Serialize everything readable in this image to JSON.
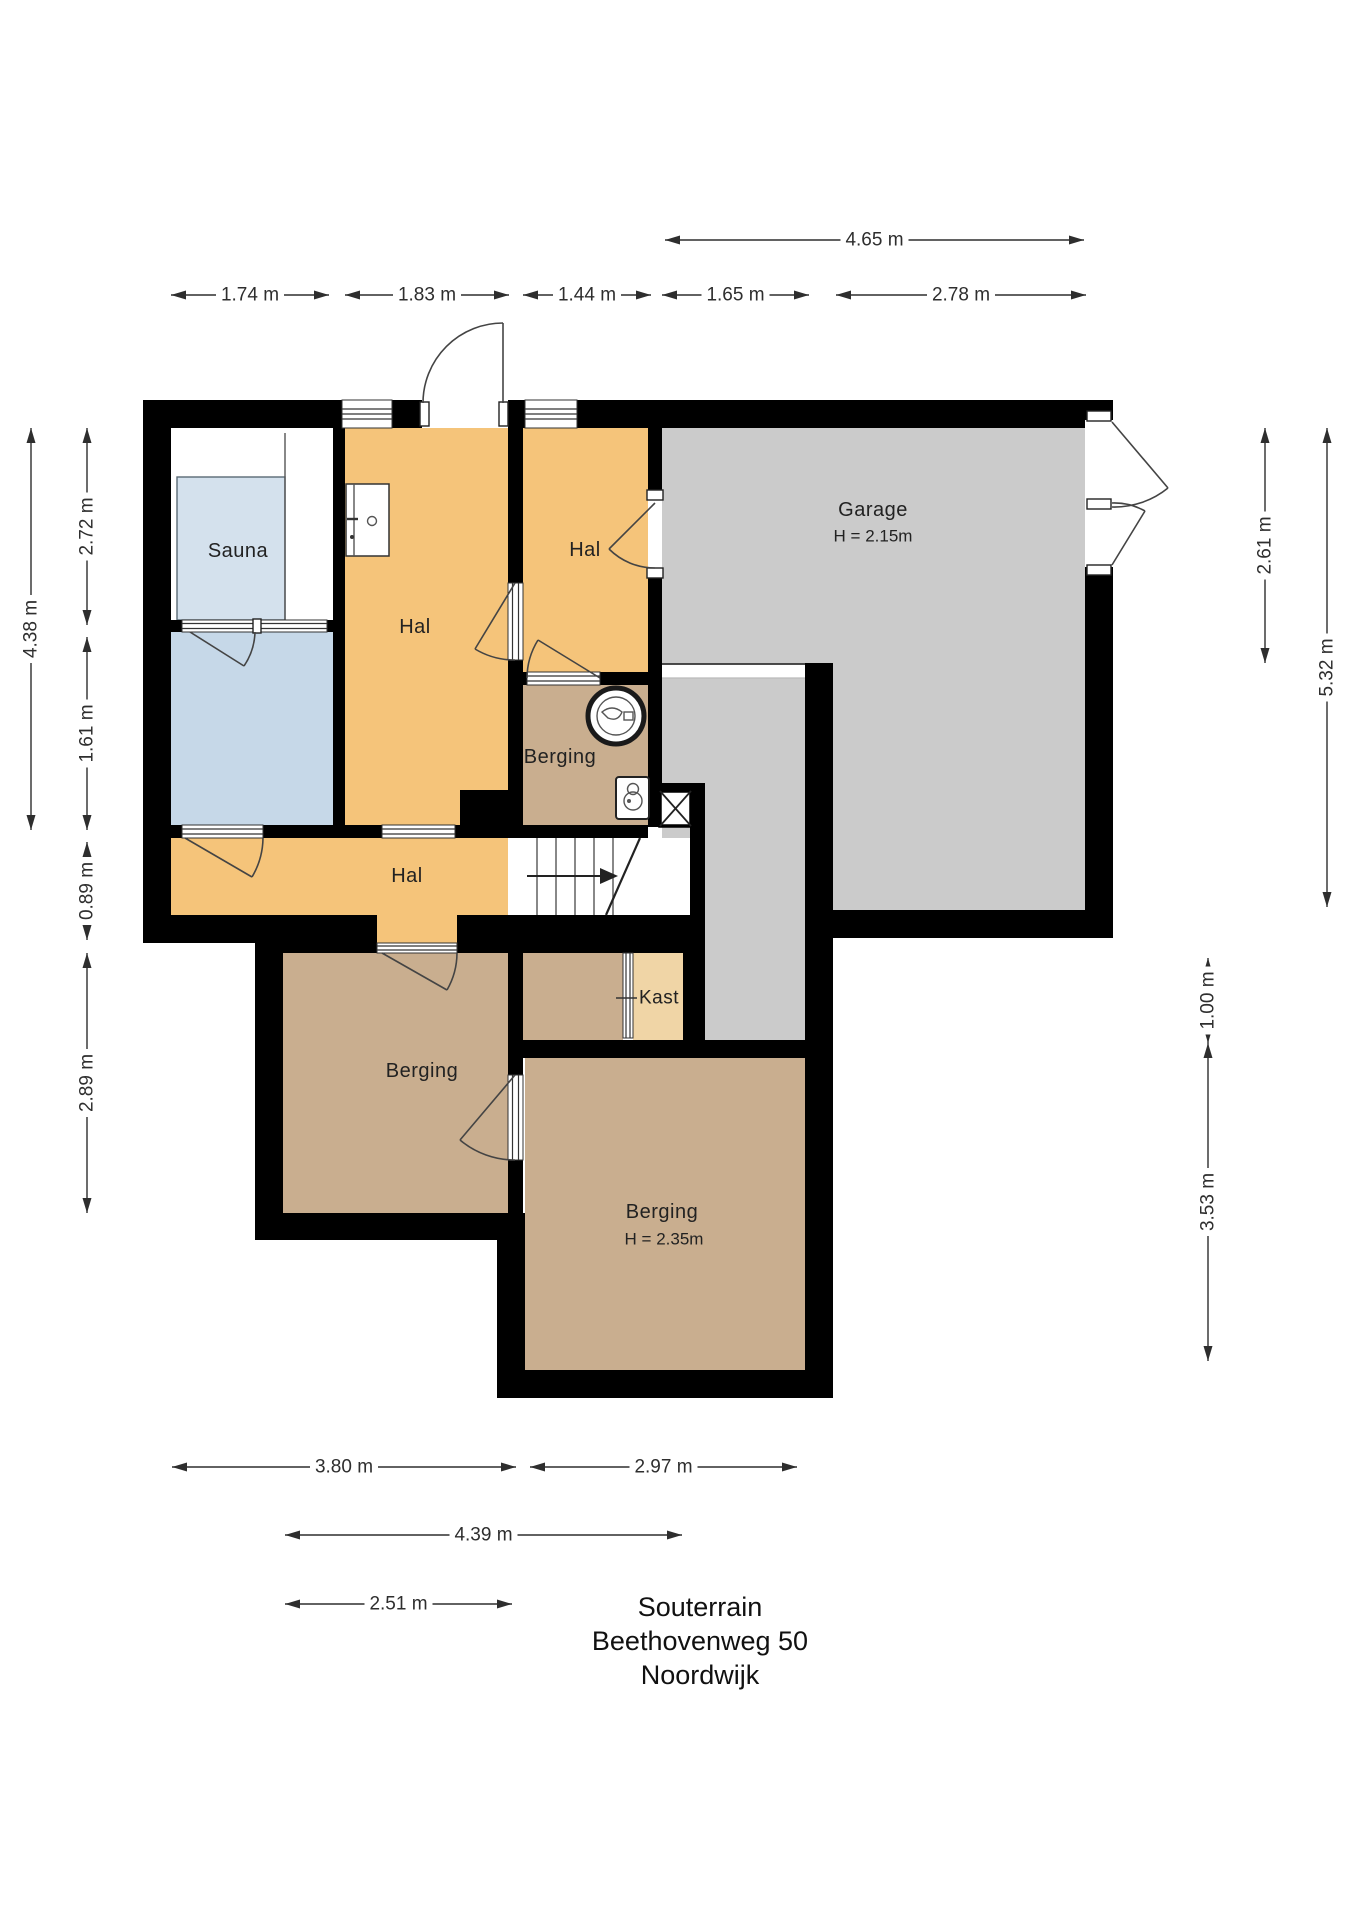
{
  "title": {
    "line1": "Souterrain",
    "line2": "Beethovenweg 50",
    "line3": "Noordwijk"
  },
  "rooms": {
    "sauna": "Sauna",
    "hall_main": "Hal",
    "hall_upper_right": "Hal",
    "hall_lower": "Hal",
    "garage": "Garage",
    "garage_height": "H = 2.15m",
    "storage_middle": "Berging",
    "storage_lower_left": "Berging",
    "storage_lower_right": "Berging",
    "storage_lower_right_height": "H = 2.35m",
    "closet": "Kast"
  },
  "dims": {
    "d_465": "4.65 m",
    "d_174": "1.74 m",
    "d_183": "1.83 m",
    "d_144": "1.44 m",
    "d_165": "1.65 m",
    "d_278": "2.78 m",
    "d_438": "4.38 m",
    "d_272": "2.72 m",
    "d_161": "1.61 m",
    "d_089": "0.89 m",
    "d_289": "2.89 m",
    "d_261": "2.61 m",
    "d_532": "5.32 m",
    "d_100": "1.00 m",
    "d_353": "3.53 m",
    "d_380": "3.80 m",
    "d_297": "2.97 m",
    "d_439": "4.39 m",
    "d_251": "2.51 m"
  },
  "icons": {
    "washing_machine": "washing-machine-icon",
    "boiler": "boiler-icon",
    "washbasin": "washbasin-icon",
    "shaft": "shaft-cross-icon",
    "stairs_arrow": "stairs-up-arrow-icon"
  },
  "colors": {
    "wall": "#000000",
    "hall": "#F5C47A",
    "storage": "#C9AE8F",
    "sauna": "#D4E1ED",
    "bath": "#C6D8E8",
    "garage": "#CBCBCB",
    "closet": "#F0D5A6",
    "dimension": "#2E2E2E"
  }
}
